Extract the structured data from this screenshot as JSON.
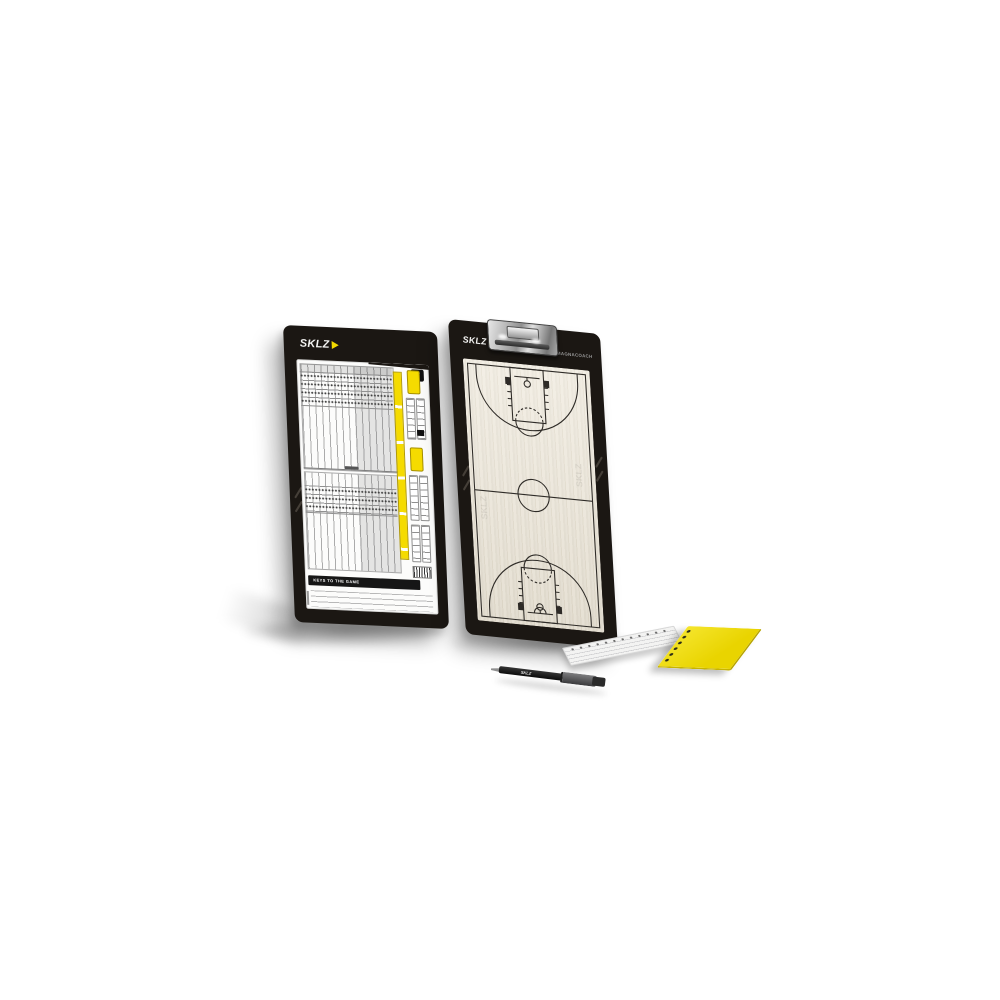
{
  "scene": {
    "background_color": "#ffffff"
  },
  "brand": {
    "wordmark": "SKLZ",
    "accent_color": "#F2DA00"
  },
  "stat_board": {
    "logo": "SKLZ",
    "corner_badge_glyph": "S",
    "banner": "KEYS TO THE GAME",
    "frame_color": "#1b1713",
    "sheet_color": "#fcfcfb",
    "highlight_color": "#F5DB00"
  },
  "court_board": {
    "logo": "SKLZ",
    "badge": "MAGNACOACH",
    "watermark": "SKLZ",
    "frame_color": "#1b1713",
    "court_color": "#e9e3d5",
    "line_color": "#2e2b27"
  },
  "accessories": {
    "marker_label": "SKLZ",
    "marker_body_color": "#141414",
    "marker_cap_color": "#5c5c5e",
    "white_pad_color": "#f3f3f2",
    "yellow_pad_color": "#efe01a"
  }
}
